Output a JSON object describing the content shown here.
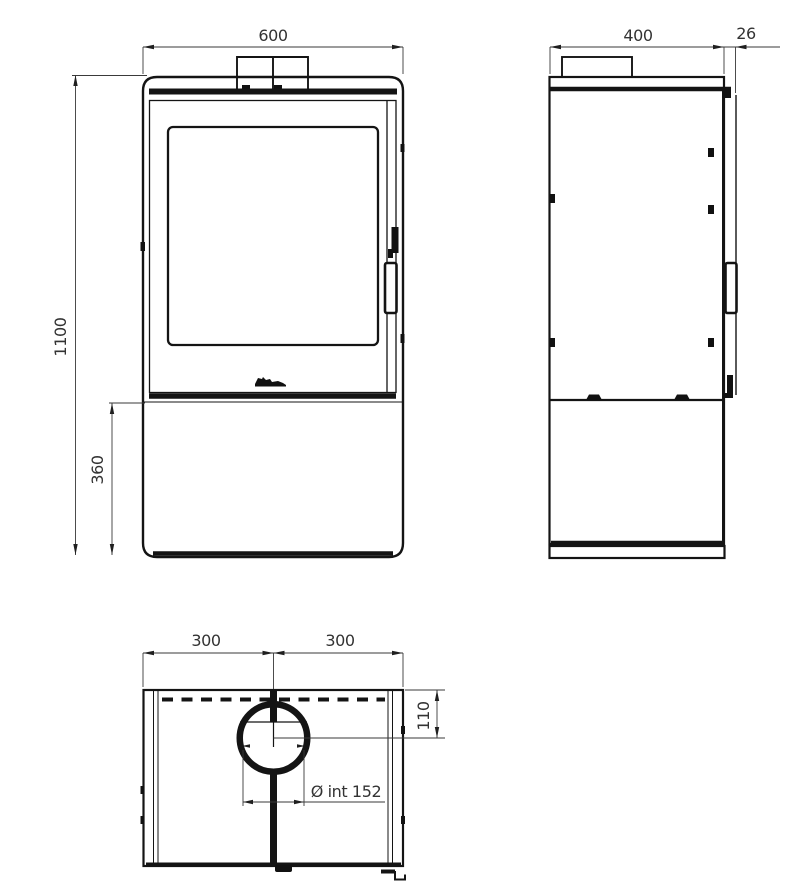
{
  "drawing": {
    "kind": "technical-dimension-drawing",
    "subject": "freestanding-stove",
    "colors": {
      "background": "#ffffff",
      "body_lines": "#141414",
      "dimension_lines": "#3a3a3a",
      "dimension_text": "#333333"
    },
    "views": {
      "front": {
        "overall_width": "600",
        "overall_height": "1100",
        "base_height": "360"
      },
      "side": {
        "depth": "400",
        "door_protrusion": "26"
      },
      "top": {
        "left_half_width": "300",
        "right_half_width": "300",
        "flue_center_offset": "110",
        "flue_inner_diameter": "Ø int 152"
      }
    }
  }
}
